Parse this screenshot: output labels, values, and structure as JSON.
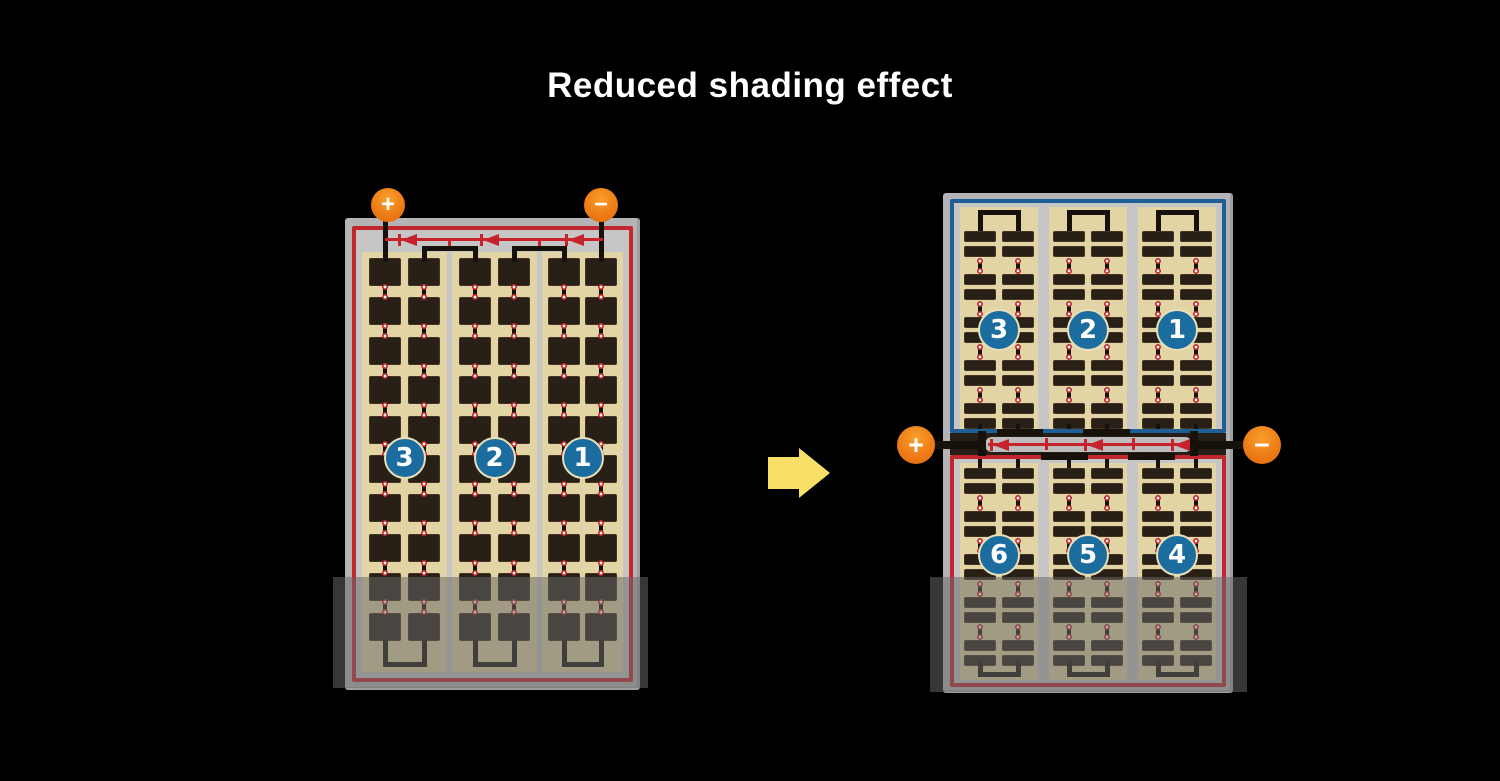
{
  "title": "Reduced shading effect",
  "colors": {
    "background": "#000000",
    "title_text": "#ffffff",
    "panel_frame": "#b4b4b6",
    "panel_inner": "#c6c6c6",
    "cell_area_tan": "#e2d4a4",
    "cell_dark": "#281f16",
    "border_red": "#c1272d",
    "border_blue": "#1e6096",
    "diode_red": "#c8232b",
    "wire_black": "#17110c",
    "badge_blue": "#1b6da0",
    "badge_ring": "#e9dfb8",
    "terminal_orange": "#ee7c17",
    "arrow_yellow": "#f8e068",
    "shade_overlay": "rgba(103,103,103,0.53)",
    "junction_dark": "#261f17",
    "diode_channel_gray": "#bdbdbd"
  },
  "arrow": {
    "direction": "right"
  },
  "panels": {
    "before": {
      "type": "full-cell-module",
      "strings": [
        "3",
        "2",
        "1"
      ],
      "terminals": [
        {
          "polarity": "positive",
          "symbol": "+"
        },
        {
          "polarity": "negative",
          "symbol": "−"
        }
      ],
      "bypass_diodes": 3,
      "columns": 3,
      "cell_rows": 10,
      "cells_per_row": 6,
      "shaded_bottom": true
    },
    "after": {
      "type": "half-cut-module",
      "top_half": {
        "border": "blue",
        "strings": [
          "3",
          "2",
          "1"
        ],
        "half_cell_row_pairs": 5
      },
      "bottom_half": {
        "border": "red",
        "strings": [
          "6",
          "5",
          "4"
        ],
        "half_cell_row_pairs": 5
      },
      "terminals": [
        {
          "polarity": "positive",
          "symbol": "+"
        },
        {
          "polarity": "negative",
          "symbol": "−"
        }
      ],
      "bypass_diodes": 3,
      "columns": 3,
      "shaded_bottom": true
    }
  }
}
